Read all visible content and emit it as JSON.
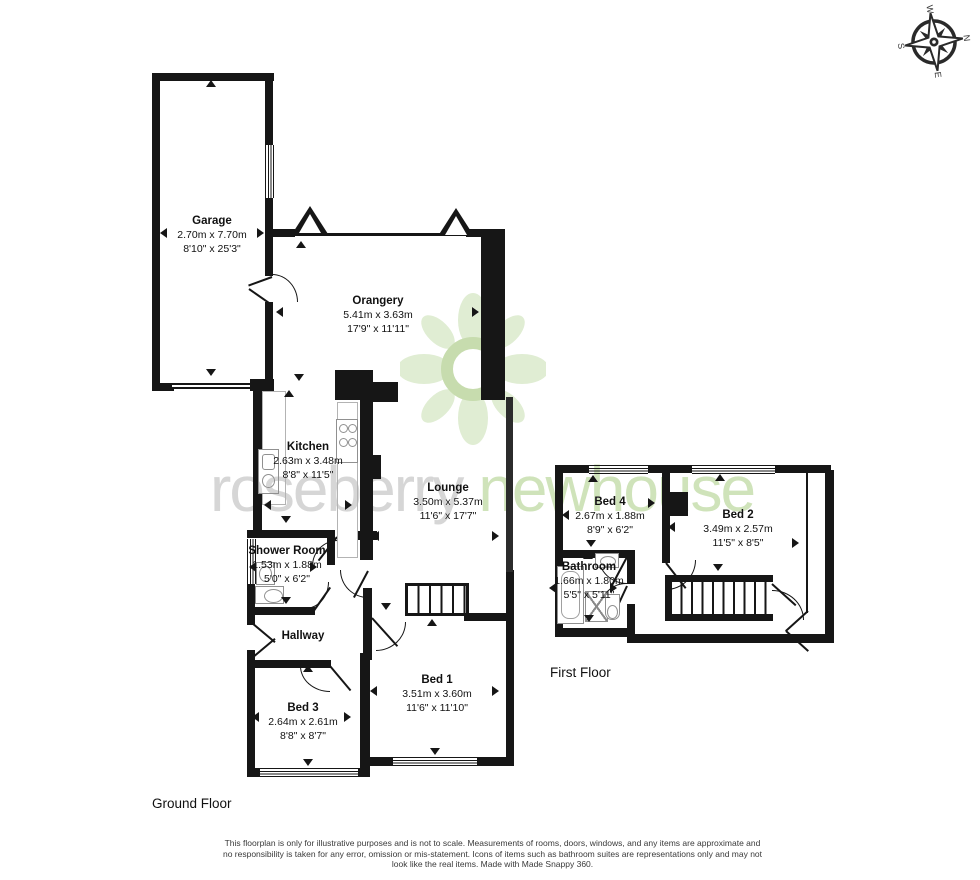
{
  "watermark": {
    "word1": "roseberry",
    "word2": "newhouse"
  },
  "compass": {
    "n": "N",
    "e": "E",
    "s": "S",
    "w": "W"
  },
  "floors": {
    "ground": {
      "label": "Ground Floor",
      "rooms": {
        "garage": {
          "name": "Garage",
          "metric": "2.70m x 7.70m",
          "imperial": "8'10\" x 25'3\""
        },
        "orangery": {
          "name": "Orangery",
          "metric": "5.41m x 3.63m",
          "imperial": "17'9\" x 11'11\""
        },
        "kitchen": {
          "name": "Kitchen",
          "metric": "2.63m x 3.48m",
          "imperial": "8'8\" x 11'5\""
        },
        "lounge": {
          "name": "Lounge",
          "metric": "3.50m x 5.37m",
          "imperial": "11'6\" x 17'7\""
        },
        "shower_room": {
          "name": "Shower Room",
          "metric": "1.53m x 1.88m",
          "imperial": "5'0\" x 6'2\""
        },
        "hallway": {
          "name": "Hallway"
        },
        "bed3": {
          "name": "Bed 3",
          "metric": "2.64m x 2.61m",
          "imperial": "8'8\" x 8'7\""
        },
        "bed1": {
          "name": "Bed 1",
          "metric": "3.51m x 3.60m",
          "imperial": "11'6\" x 11'10\""
        }
      }
    },
    "first": {
      "label": "First Floor",
      "rooms": {
        "bed4": {
          "name": "Bed 4",
          "metric": "2.67m x 1.88m",
          "imperial": "8'9\" x 6'2\""
        },
        "bed2": {
          "name": "Bed 2",
          "metric": "3.49m x 2.57m",
          "imperial": "11'5\" x 8'5\""
        },
        "bathroom": {
          "name": "Bathroom",
          "metric": "1.66m x 1.80m",
          "imperial": "5'5\" x 5'11\""
        }
      }
    }
  },
  "disclaimer": "This floorplan is only for illustrative purposes and is not to scale. Measurements of rooms, doors, windows, and any items are approximate and no responsibility is taken for any error, omission or mis-statement. Icons of items such as bathroom suites are representations only and may not look like the real items. Made with Made Snappy 360.",
  "colors": {
    "wall": "#161616",
    "watermark_gray": "#d6d6d6",
    "watermark_green": "#cfe3ba",
    "logo_petal": "#e0edd3",
    "logo_ring": "#c7dcae"
  }
}
